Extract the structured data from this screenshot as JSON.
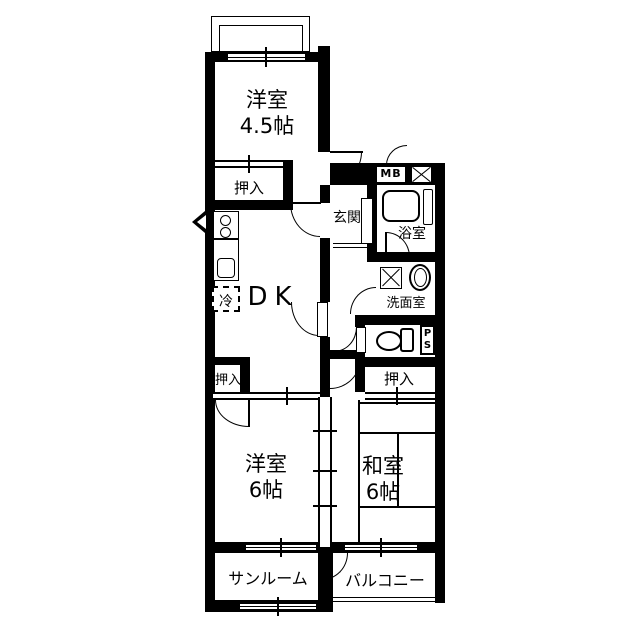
{
  "plan_title": "2DK apartment floor plan",
  "colors": {
    "line": "#000000",
    "background": "#ffffff"
  },
  "rooms": {
    "western_small": {
      "label": "洋室",
      "size": "4.5帖"
    },
    "dk": {
      "label": "DK"
    },
    "entrance": {
      "label": "玄関"
    },
    "bathroom": {
      "label": "浴室"
    },
    "washroom": {
      "label": "洗面室"
    },
    "western": {
      "label": "洋室",
      "size": "6帖"
    },
    "japanese": {
      "label": "和室",
      "size": "6帖"
    },
    "sunroom": {
      "label": "サンルーム"
    },
    "balcony": {
      "label": "バルコニー"
    }
  },
  "closets": {
    "top": {
      "label": "押入"
    },
    "west": {
      "label": "押入"
    },
    "east": {
      "label": "押入"
    }
  },
  "fixtures": {
    "refrigerator": {
      "label": "冷"
    },
    "meter_box": {
      "label": "MB"
    },
    "pipe_space_p": {
      "label": "P"
    },
    "pipe_space_s": {
      "label": "S"
    }
  }
}
